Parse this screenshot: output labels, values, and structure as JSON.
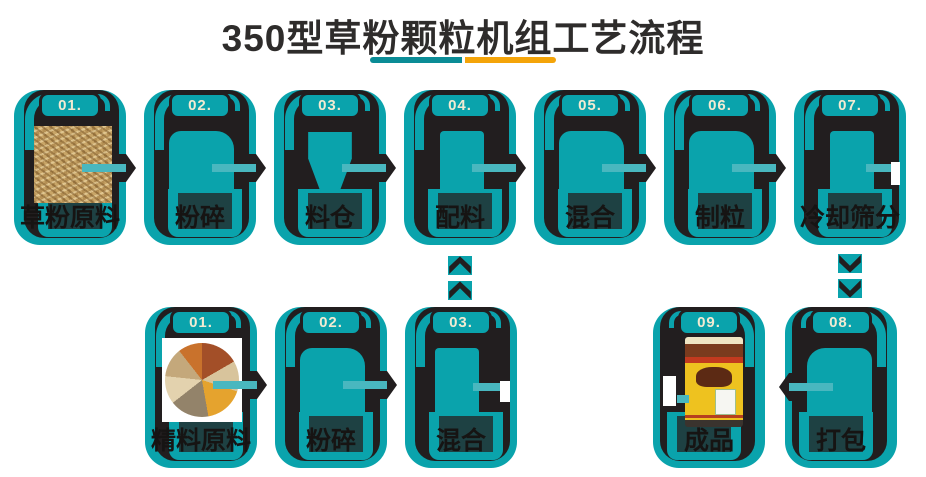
{
  "title": {
    "text": "350型草粉颗粒机组工艺流程"
  },
  "divider": {
    "left_color": "#0A8C96",
    "right_color": "#F4A409"
  },
  "palette": {
    "teal": "#0AA3AC",
    "ink": "#221E1F",
    "badge_text": "#F2EBD2",
    "dark_band": "#1E4143",
    "label_text": "#161413",
    "title_text": "#2E2C2B",
    "arrow_bar": "#49B7BF"
  },
  "flow": {
    "top_row": [
      {
        "number": "01.",
        "label": "草粉原料",
        "image": "grass-powder-photo"
      },
      {
        "number": "02.",
        "label": "粉碎",
        "image": "crusher-silhouette"
      },
      {
        "number": "03.",
        "label": "料仓",
        "image": "silo-silhouette"
      },
      {
        "number": "04.",
        "label": "配料",
        "image": "batcher-silhouette"
      },
      {
        "number": "05.",
        "label": "混合",
        "image": "mixer-silhouette"
      },
      {
        "number": "06.",
        "label": "制粒",
        "image": "pelletizer-silhouette"
      },
      {
        "number": "07.",
        "label": "冷却筛分",
        "image": "cooler-silhouette"
      }
    ],
    "bottom_left_row": [
      {
        "number": "01.",
        "label": "精料原料",
        "image": "grain-mix-photo"
      },
      {
        "number": "02.",
        "label": "粉碎",
        "image": "crusher-silhouette"
      },
      {
        "number": "03.",
        "label": "混合",
        "image": "mixer-silhouette"
      }
    ],
    "bottom_right_row": [
      {
        "number": "09.",
        "label": "成品",
        "image": "feed-bag-photo"
      },
      {
        "number": "08.",
        "label": "打包",
        "image": "packer-silhouette"
      }
    ],
    "connectors": [
      {
        "type": "chevron-up",
        "count": 2
      },
      {
        "type": "chevron-down",
        "count": 2
      }
    ]
  }
}
